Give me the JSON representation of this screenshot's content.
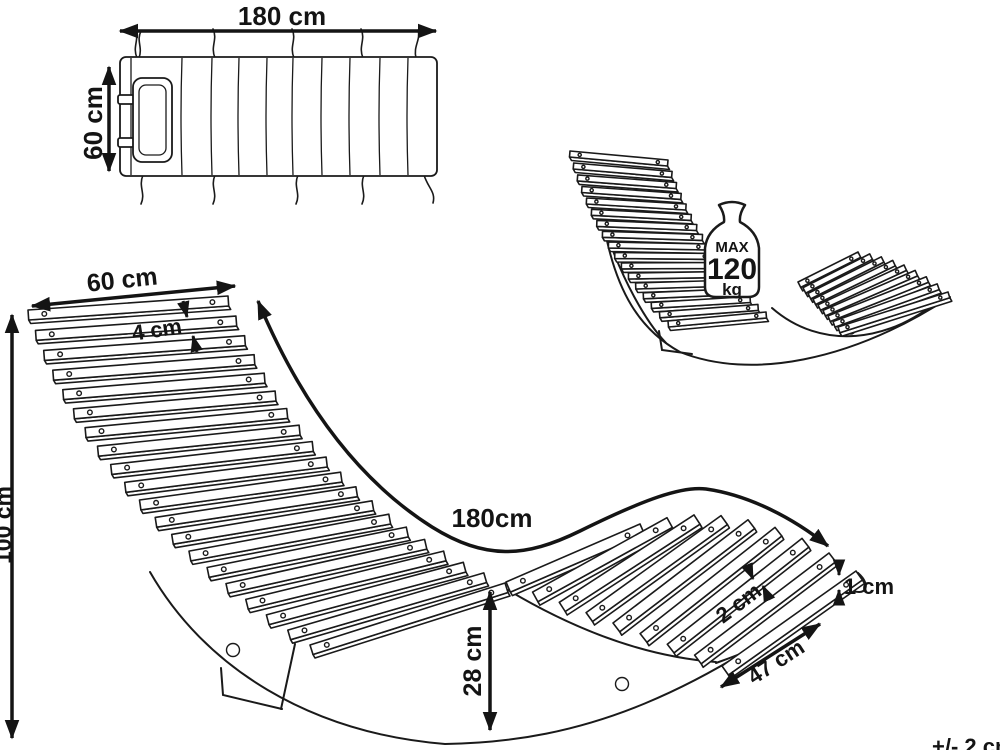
{
  "cushion_view": {
    "length_label": "180 cm",
    "width_label": "60 cm"
  },
  "perspective_view": {
    "max_load": {
      "label": "MAX",
      "value": "120",
      "unit": "kg"
    }
  },
  "side_view": {
    "back_width_label": "60 cm",
    "back_slat_gap_label": "4 cm",
    "overall_height_label": "100 cm",
    "surface_length_label": "180cm",
    "mid_height_label": "28 cm",
    "slat_thickness_label": "1 cm",
    "seat_slat_gap_label": "2 cm",
    "seat_depth_label": "47 cm"
  },
  "tolerance_label": "+/- 2 cm",
  "colors": {
    "line": "#141414",
    "background": "#ffffff"
  }
}
